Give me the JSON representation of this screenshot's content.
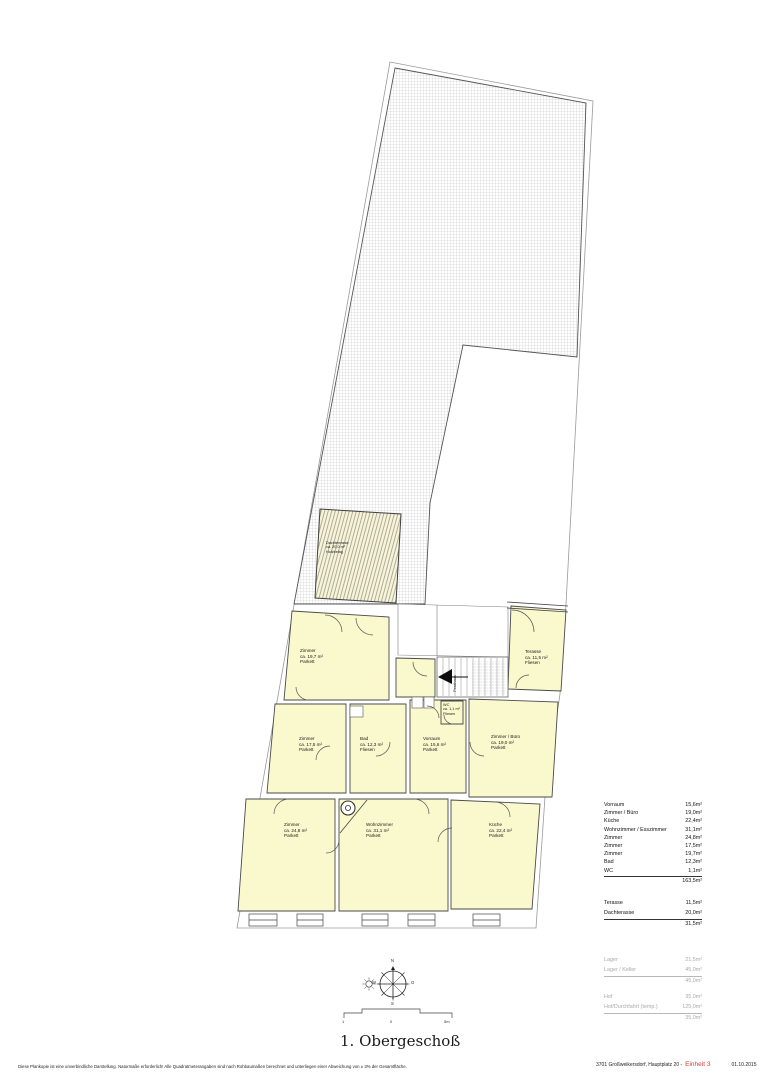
{
  "page": {
    "title": "1. Obergeschoß",
    "disclaimer": "Diese Plankopie ist eine unverbindliche Darstellung. Naturmaße erforderlich! Alle Quadratmeterangaben sind nach Rohbaumaßen berechnet und unterliegen einer Abweichung von ± 3% der Gesamtfläche.",
    "address": "3701 Großweikersdorf, Hauptplatz 20 -",
    "unit": "Einheit 3",
    "date": "01.10.2015"
  },
  "colors": {
    "room_fill": "#FAF8CD",
    "unit_red": "#E03A2F",
    "muted_gray": "#A9A9A9"
  },
  "plan": {
    "rooms": [
      {
        "name": "Zimmer",
        "area": "ca. 19,7 m²",
        "floor": "Parkett"
      },
      {
        "name": "Terasse",
        "area": "ca. 11,5 m²",
        "floor": "Fliesen"
      },
      {
        "name": "WC",
        "area": "ca. 1,1 m²",
        "floor": "Fliesen"
      },
      {
        "name": "Zimmer",
        "area": "ca. 17,5 m²",
        "floor": "Parkett"
      },
      {
        "name": "Bad",
        "area": "ca. 12,3 m²",
        "floor": "Fliesen"
      },
      {
        "name": "Vorraum",
        "area": "ca. 15,6 m²",
        "floor": "Parkett"
      },
      {
        "name": "Zimmer / Büro",
        "area": "ca. 19,0 m²",
        "floor": "Parkett"
      },
      {
        "name": "Zimmer",
        "area": "ca. 24,8 m²",
        "floor": "Parkett"
      },
      {
        "name": "Wohnzimmer",
        "area": "ca. 31,1 m²",
        "floor": "Parkett"
      },
      {
        "name": "Küche",
        "area": "ca. 22,4 m²",
        "floor": "Parkett"
      },
      {
        "name": "Dachterrasse",
        "area": "ca. 20,0 m²",
        "floor": "Holzbelag"
      }
    ],
    "stair_label": "Penthaus",
    "compass": {
      "north": "N",
      "east": "O",
      "south": "S",
      "west": "W"
    },
    "scale_bar": {
      "left": "1",
      "mid": "0",
      "right": "5m"
    }
  },
  "area_table": {
    "groups": [
      {
        "rows": [
          {
            "label": "Vorraum",
            "value": "15,6m²"
          },
          {
            "label": "Zimmer / Büro",
            "value": "19,0m²"
          },
          {
            "label": "Küche",
            "value": "22,4m²"
          },
          {
            "label": "Wohnzimmer / Esszimmer",
            "value": "31,1m²"
          },
          {
            "label": "Zimmer",
            "value": "24,8m²"
          },
          {
            "label": "Zimmer",
            "value": "17,5m²"
          },
          {
            "label": "Zimmer",
            "value": "19,7m²"
          },
          {
            "label": "Bad",
            "value": "12,3m²"
          },
          {
            "label": "WC",
            "value": "1,1m²"
          }
        ],
        "total": "163,5m²"
      },
      {
        "rows": [
          {
            "label": "Terasse",
            "value": "11,5m²"
          },
          {
            "label": "Dachterasse",
            "value": "20,0m²"
          }
        ],
        "total": "31,5m²"
      },
      {
        "rows": [
          {
            "label": "Lager",
            "value": "21,5m²"
          },
          {
            "label": "Lager / Keller",
            "value": "45,0m²"
          }
        ],
        "total": "45,0m²"
      },
      {
        "rows": [
          {
            "label": "Hof",
            "value": "35,0m²"
          },
          {
            "label": "Hof/Durchfahrt (temp.)",
            "value": "125,0m²"
          }
        ],
        "total": "35,0m²"
      }
    ]
  }
}
